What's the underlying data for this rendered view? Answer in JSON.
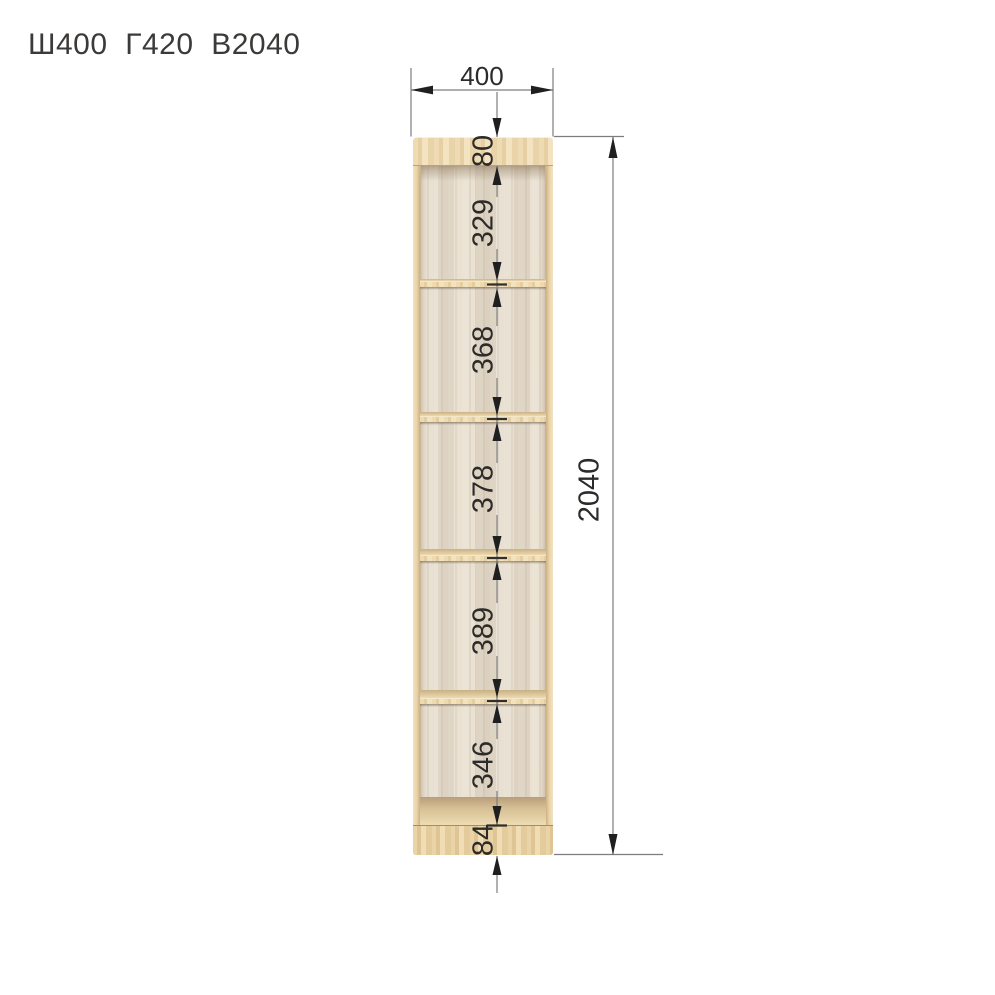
{
  "title": "Ш400  Г420  В2040",
  "dimensions": {
    "width": "400",
    "height": "2040",
    "sections": [
      "80",
      "329",
      "368",
      "378",
      "389",
      "346",
      "84"
    ]
  },
  "colors": {
    "dimension_line": "#7d7d7d",
    "tick": "#2f2f2f",
    "arrow": "#1f1f1f",
    "dimension_text": "#2c2b29",
    "wood_front": "#ead5ab",
    "wood_back": "#e2d9ca",
    "background": "#ffffff"
  }
}
